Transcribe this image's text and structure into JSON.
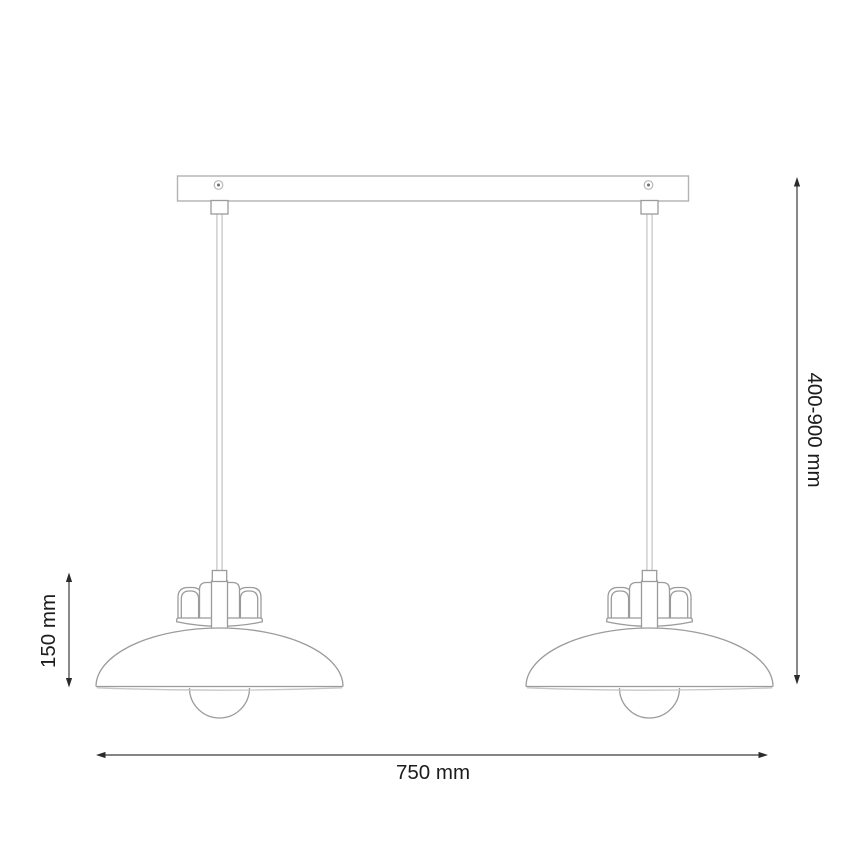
{
  "drawing": {
    "subject": "pendant-lamp-dimension-drawing",
    "colors": {
      "background": "#ffffff",
      "lamp_outline": "#9b9b9b",
      "light_detail": "#c7c7c7",
      "dimension_line": "#3a3a3a",
      "dimension_text": "#1c1c1c"
    }
  },
  "dimensions": {
    "overall_width": {
      "label": "750 mm"
    },
    "shade_height": {
      "label": "150 mm"
    },
    "suspension_range": {
      "label": "400-900 mm"
    }
  }
}
